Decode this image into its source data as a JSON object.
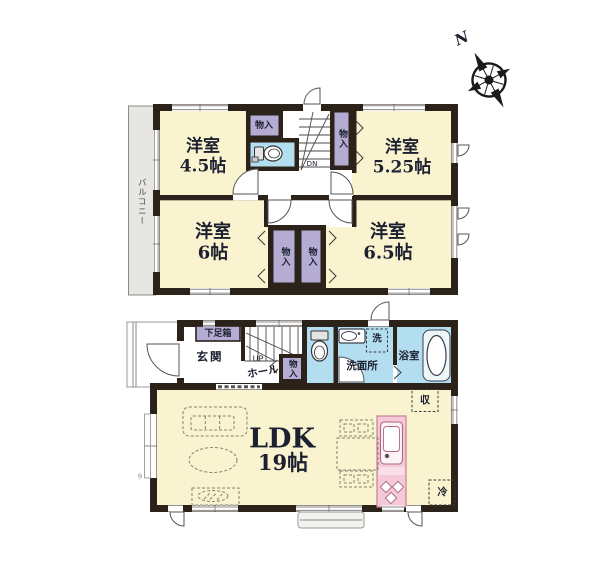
{
  "colors": {
    "wall": "#2b2219",
    "room_cream": "#faf3cf",
    "closet_purple": "#b5acd4",
    "water_blue": "#b2def0",
    "kitchen_pink": "#f6c9d7",
    "balcony_gray": "#e7e6e3"
  },
  "compass": {
    "north_label": "N"
  },
  "floor2": {
    "balcony": "バルコニー",
    "room_tl": "洋室\n4.5帖",
    "room_tr": "洋室\n5.25帖",
    "room_bl": "洋室\n6帖",
    "room_br": "洋室\n6.5帖",
    "closet_top": "物入",
    "closet_right": "物入",
    "closet_b1": "物入",
    "closet_b2": "物入",
    "stairs_down": "DN"
  },
  "floor1": {
    "shoe_box": "下足箱",
    "entrance": "玄関",
    "stairs_up": "UP",
    "hall": "ホール",
    "closet": "物入",
    "washroom": "洗面所",
    "laundry": "洗",
    "bathroom": "浴室",
    "ldk_name": "LDK",
    "ldk_size": "19帖",
    "storage": "収",
    "fridge": "冷",
    "dim_mark": "9"
  }
}
